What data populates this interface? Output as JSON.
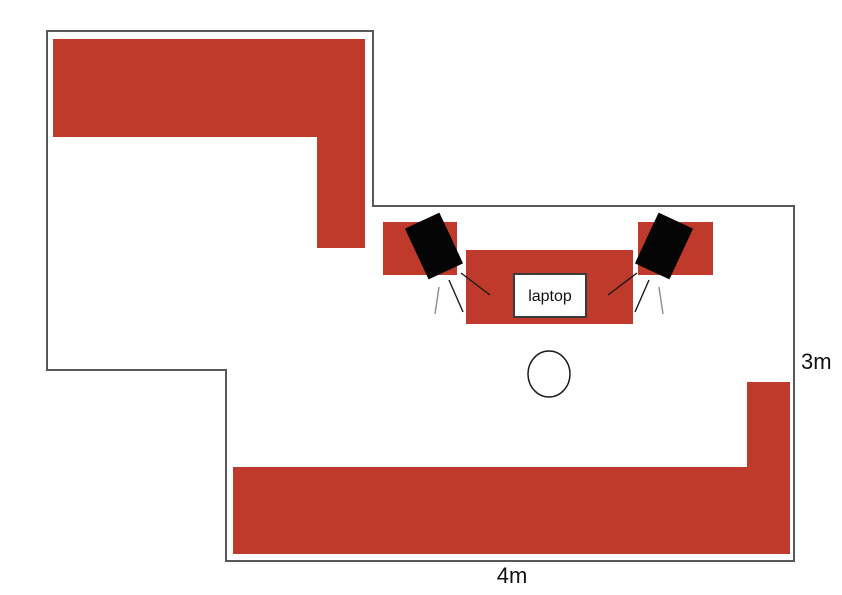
{
  "diagram": {
    "labels": {
      "laptop": "laptop",
      "room_width": "4m",
      "room_height": "3m"
    },
    "colors": {
      "furniture": "#BF3A2B",
      "speaker": "#050505",
      "wall": "#58585A",
      "line_dark": "#1A1A1A",
      "line_gray": "#8C8C8C",
      "laptop_fill": "#FFFFFF",
      "laptop_border": "#3A3A3A",
      "text": "#111111",
      "background": "#FFFFFF"
    }
  }
}
